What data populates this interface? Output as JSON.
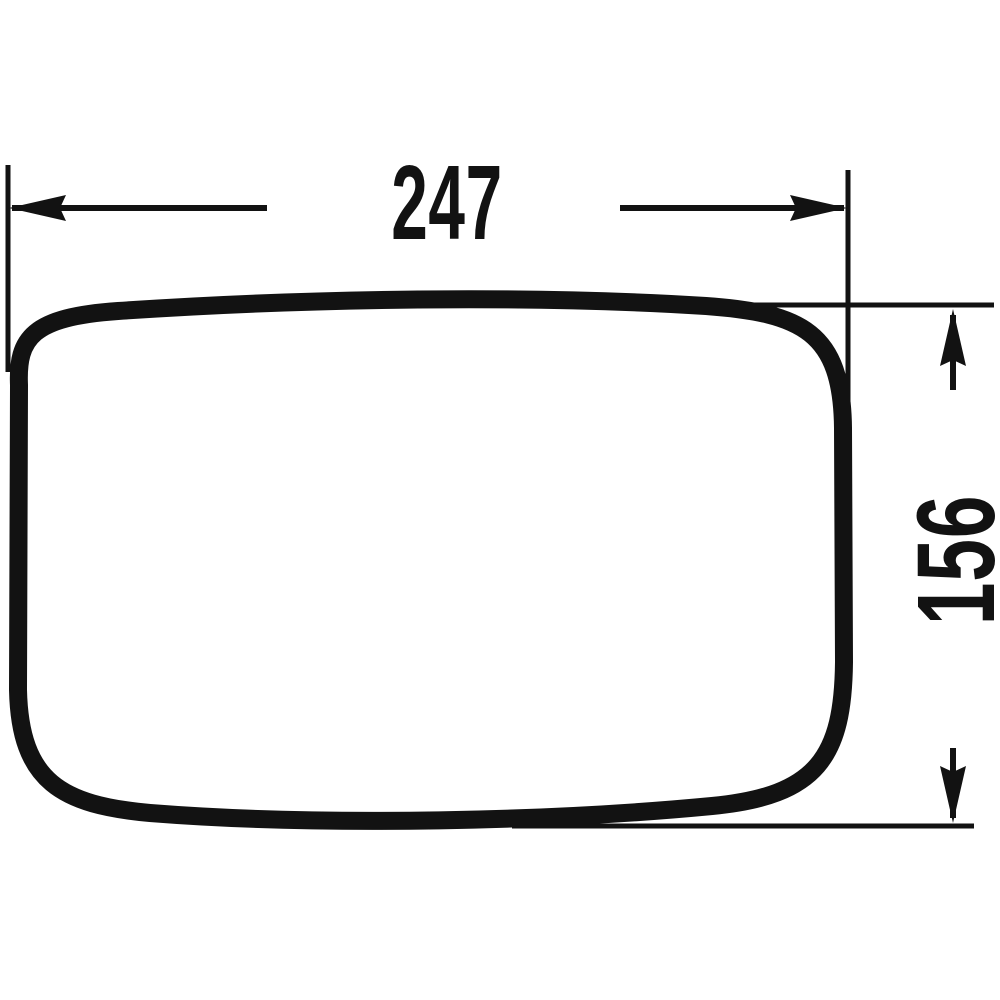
{
  "drawing": {
    "type": "technical-dimension-drawing",
    "part": "rounded-rectangle-outline",
    "colors": {
      "line": "#121212",
      "background": "#ffffff"
    },
    "dimensions": {
      "width": {
        "value": "247"
      },
      "height": {
        "value": "156"
      }
    }
  }
}
